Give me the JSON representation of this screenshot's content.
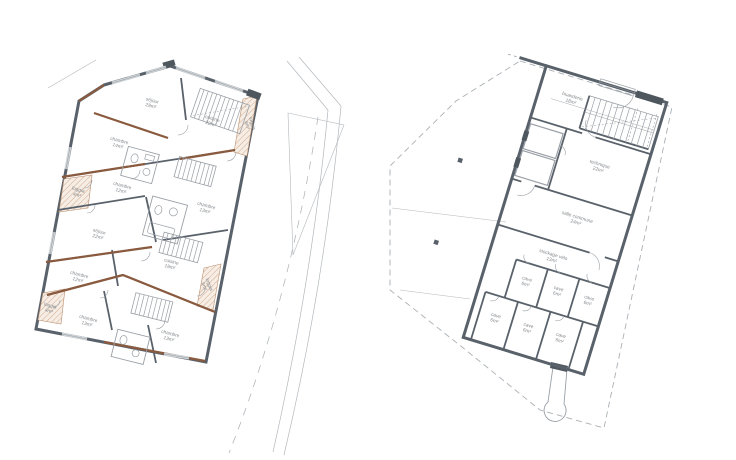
{
  "colors": {
    "wall": "#59616a",
    "wall_dark": "#4e565e",
    "wood_accent": "#8a5a3e",
    "hatch_line": "#d3ab8e",
    "hatch_bg": "#f6ede5",
    "thin_line": "#9aa0a6",
    "boundary_dash": "#aab0b5",
    "label_text": "#85898d",
    "background": "#ffffff"
  },
  "left_plan": {
    "name": "floor-plan-apartments",
    "rooms": [
      {
        "label": "séjour",
        "area": "28m²",
        "x": 152,
        "y": 102,
        "r": 15
      },
      {
        "label": "cuisine",
        "area": "22m²",
        "x": 212,
        "y": 120,
        "r": 18
      },
      {
        "label": "loggia",
        "area": "8m²",
        "x": 251,
        "y": 124,
        "r": 72
      },
      {
        "label": "chambre",
        "area": "14m²",
        "x": 119,
        "y": 142,
        "r": 15
      },
      {
        "label": "loggia",
        "area": "4m²",
        "x": 78,
        "y": 191,
        "r": 15
      },
      {
        "label": "chambre",
        "area": "12m²",
        "x": 122,
        "y": 187,
        "r": 15
      },
      {
        "label": "chambre",
        "area": "13m²",
        "x": 206,
        "y": 207,
        "r": 15
      },
      {
        "label": "séjour",
        "area": "22m²",
        "x": 99,
        "y": 233,
        "r": 15
      },
      {
        "label": "cuisine",
        "area": "18m²",
        "x": 171,
        "y": 263,
        "r": 15
      },
      {
        "label": "loggia",
        "area": "6m²",
        "x": 208,
        "y": 285,
        "r": 70
      },
      {
        "label": "chambre",
        "area": "12m²",
        "x": 79,
        "y": 276,
        "r": 15
      },
      {
        "label": "loggia",
        "area": "4m²",
        "x": 50,
        "y": 307,
        "r": 15
      },
      {
        "label": "chambre",
        "area": "13m²",
        "x": 88,
        "y": 320,
        "r": 15
      },
      {
        "label": "chambre",
        "area": "13m²",
        "x": 170,
        "y": 335,
        "r": 15
      }
    ]
  },
  "right_plan": {
    "name": "floor-plan-basement",
    "rooms": [
      {
        "label": "buanderie",
        "area": "18m²",
        "x": 536,
        "y": 101
      },
      {
        "label": "technique",
        "area": "22m²",
        "x": 582,
        "y": 158
      },
      {
        "label": "salle commune",
        "area": "24m²",
        "x": 576,
        "y": 215
      },
      {
        "label": "stockage vélo",
        "area": "13m²",
        "x": 564,
        "y": 258
      },
      {
        "label": "cave",
        "area": "6m²",
        "x": 546,
        "y": 289
      },
      {
        "label": "cave",
        "area": "6m²",
        "x": 579,
        "y": 289
      },
      {
        "label": "cave",
        "area": "6m²",
        "x": 611,
        "y": 289
      },
      {
        "label": "cave",
        "area": "6m²",
        "x": 527,
        "y": 333
      },
      {
        "label": "cave",
        "area": "6m²",
        "x": 561,
        "y": 333
      },
      {
        "label": "cave",
        "area": "6m²",
        "x": 595,
        "y": 333
      }
    ]
  }
}
